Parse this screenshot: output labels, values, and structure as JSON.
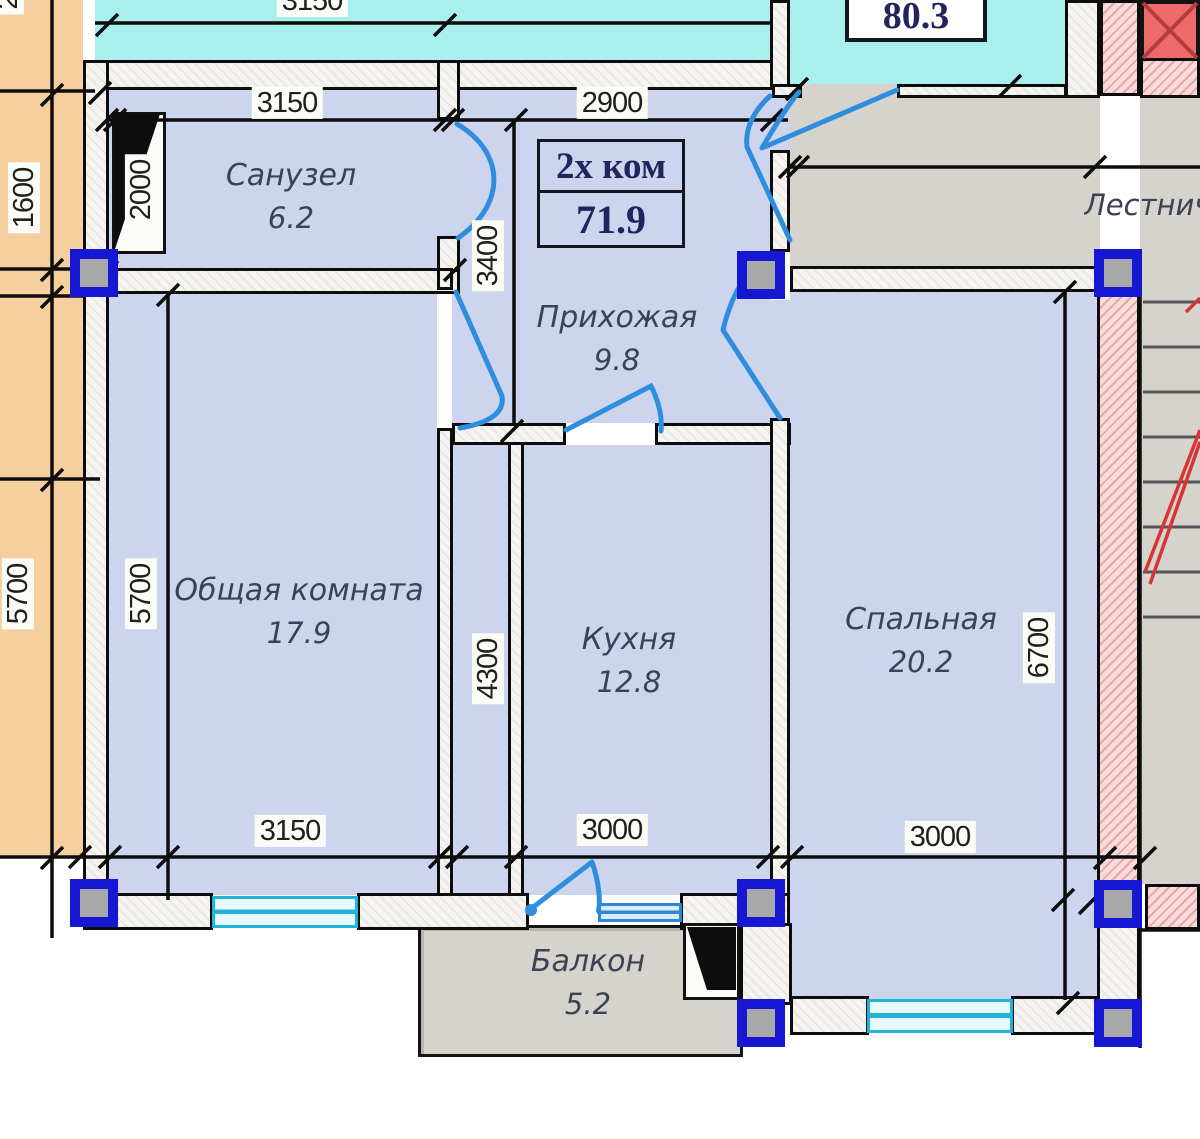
{
  "plan": {
    "title": {
      "type": "2х ком",
      "area": "71.9"
    },
    "neighbor_area": "80.3",
    "rooms": {
      "sanuzel": {
        "name": "Санузел",
        "area": "6.2"
      },
      "prihozhaya": {
        "name": "Прихожая",
        "area": "9.8"
      },
      "obshchaya": {
        "name": "Общая комната",
        "area": "17.9"
      },
      "kuhnya": {
        "name": "Кухня",
        "area": "12.8"
      },
      "spalnaya": {
        "name": "Спальная",
        "area": "20.2"
      },
      "balkon": {
        "name": "Балкон",
        "area": "5.2"
      },
      "lestnitsa": {
        "name": "Лестничная"
      }
    },
    "dims": {
      "top_neighbor": "3150",
      "sanuzel_top": "3150",
      "hall_top": "2900",
      "left_1600": "1600",
      "vent_2000": "2000",
      "hall_3400": "3400",
      "far_left_5700": "5700",
      "living_5700": "5700",
      "kitchen_4300": "4300",
      "bedroom_6700": "6700",
      "living_bottom": "3150",
      "kitchen_bottom": "3000",
      "bedroom_bottom": "3000",
      "corner_cut": "2"
    },
    "colors": {
      "room_fill": "#cdd4ee",
      "neighbor_cyan": "#a9efee",
      "neighbor_peach": "#f6cf9f",
      "corridor_gray": "#d6d3cc",
      "stair_room_red": "#ef6b6b",
      "door_blue": "#2e8edd",
      "window_cyan": "#25b2d8",
      "column_blue": "#1617d2",
      "wall_pink_hatch": "#e9a6a6"
    }
  }
}
